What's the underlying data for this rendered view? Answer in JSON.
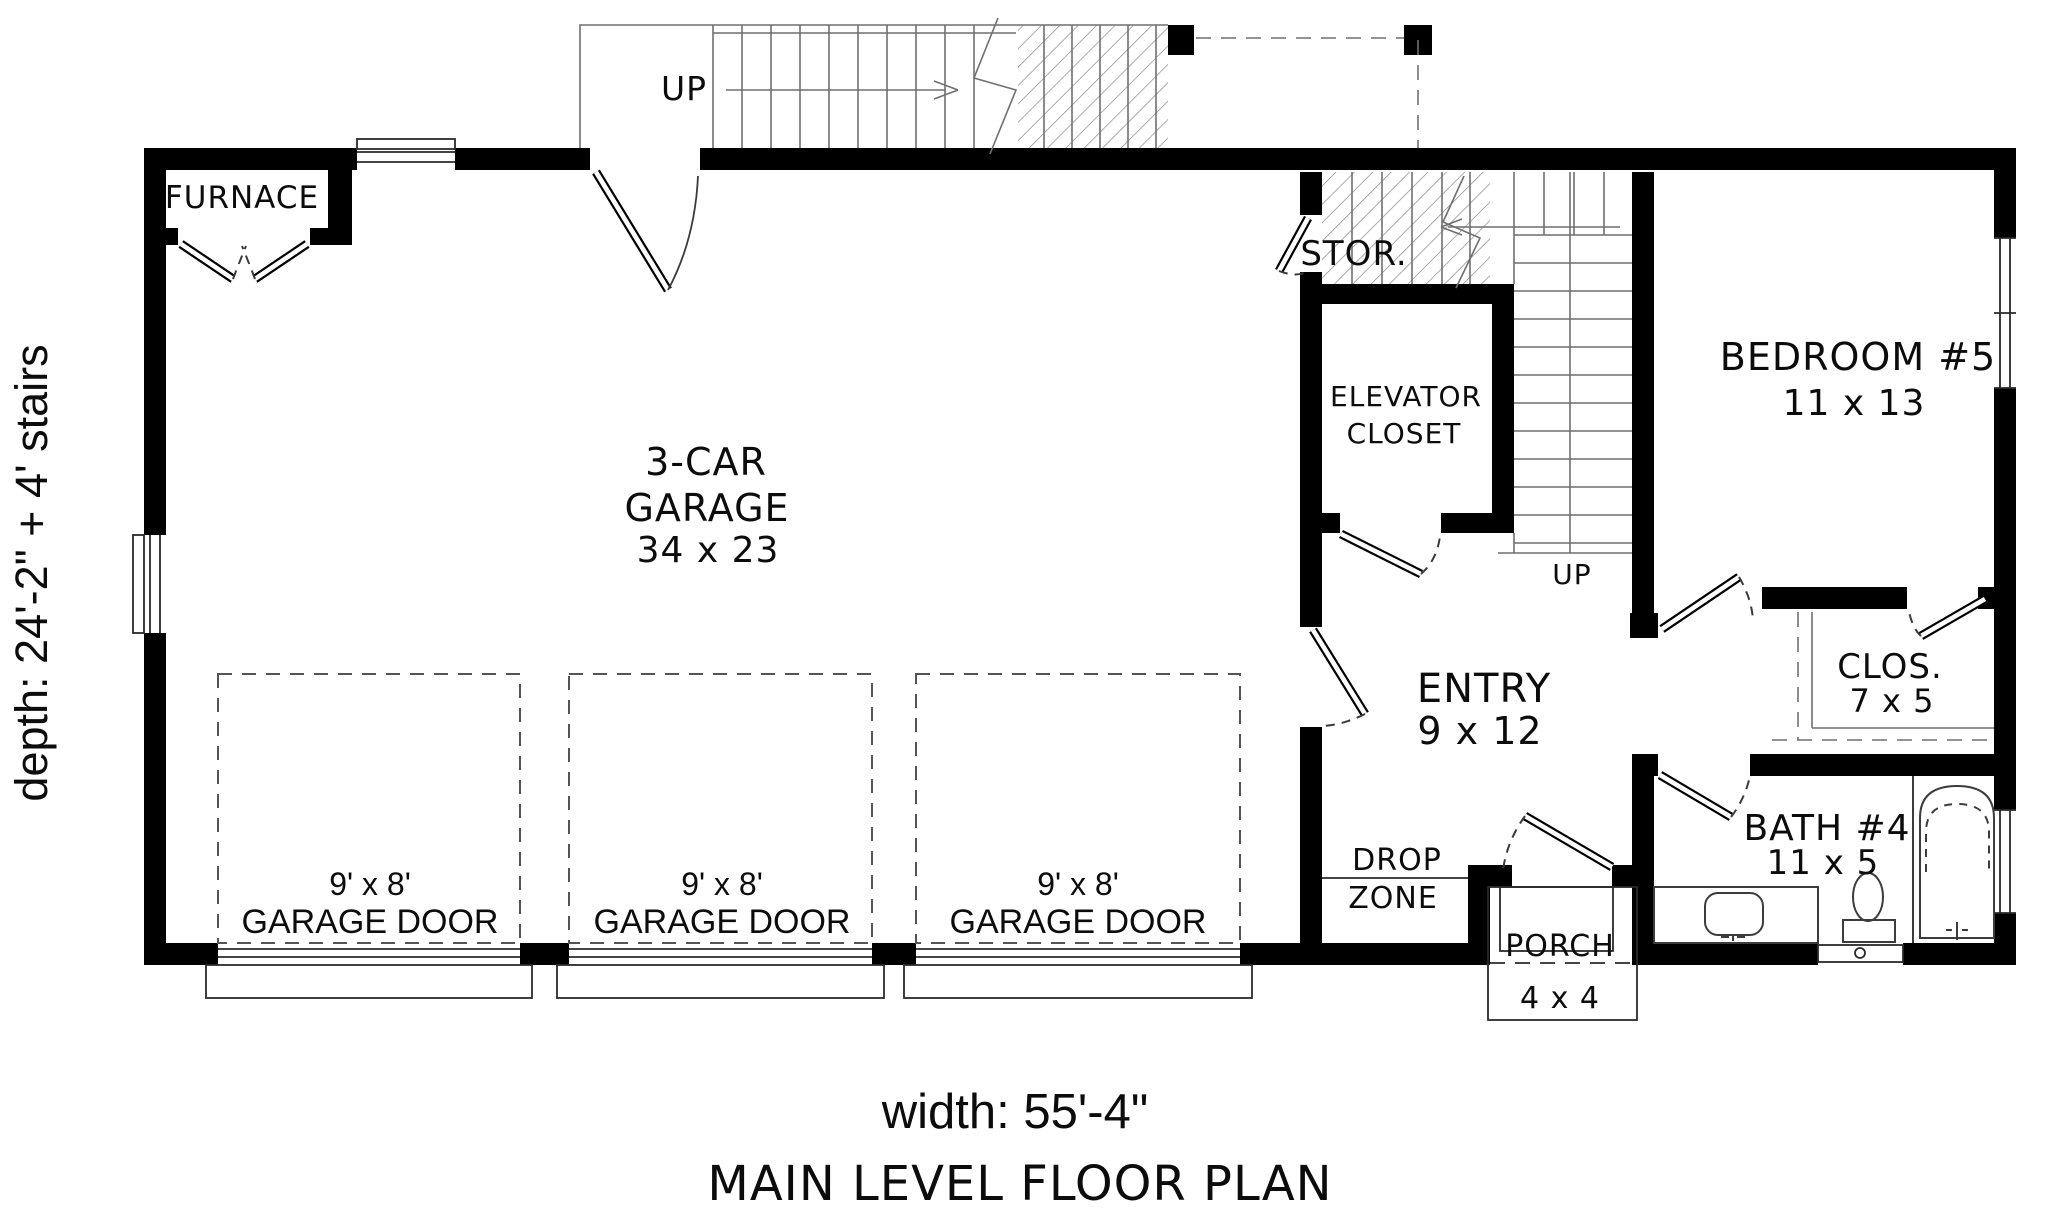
{
  "plan": {
    "title": "MAIN LEVEL FLOOR PLAN",
    "width_dimension": "width: 55'-4\"",
    "depth_dimension": "depth: 24'-2\" + 4' stairs"
  },
  "rooms": {
    "furnace": {
      "name": "FURNACE"
    },
    "garage": {
      "line1": "3-CAR",
      "line2": "GARAGE",
      "dims": "34 x 23"
    },
    "storage": {
      "name": "STOR."
    },
    "elevator_closet": {
      "line1": "ELEVATOR",
      "line2": "CLOSET"
    },
    "bedroom": {
      "name": "BEDROOM #5",
      "dims": "11 x 13"
    },
    "entry": {
      "name": "ENTRY",
      "dims": "9 x 12"
    },
    "closet": {
      "name": "CLOS.",
      "dims": "7 x 5"
    },
    "bath": {
      "name": "BATH #4",
      "dims": "11 x 5"
    },
    "drop_zone": {
      "line1": "DROP",
      "line2": "ZONE"
    },
    "porch": {
      "name": "PORCH",
      "dims": "4 x 4"
    }
  },
  "stairs": {
    "upper_up_label": "UP",
    "entry_up_label": "UP"
  },
  "garage_doors": [
    {
      "size": "9' x 8'",
      "label": "GARAGE DOOR"
    },
    {
      "size": "9' x 8'",
      "label": "GARAGE DOOR"
    },
    {
      "size": "9' x 8'",
      "label": "GARAGE DOOR"
    }
  ],
  "colors": {
    "wall": "#000000",
    "line": "#141414",
    "hatch": "#8a8a8a",
    "background": "#ffffff"
  }
}
